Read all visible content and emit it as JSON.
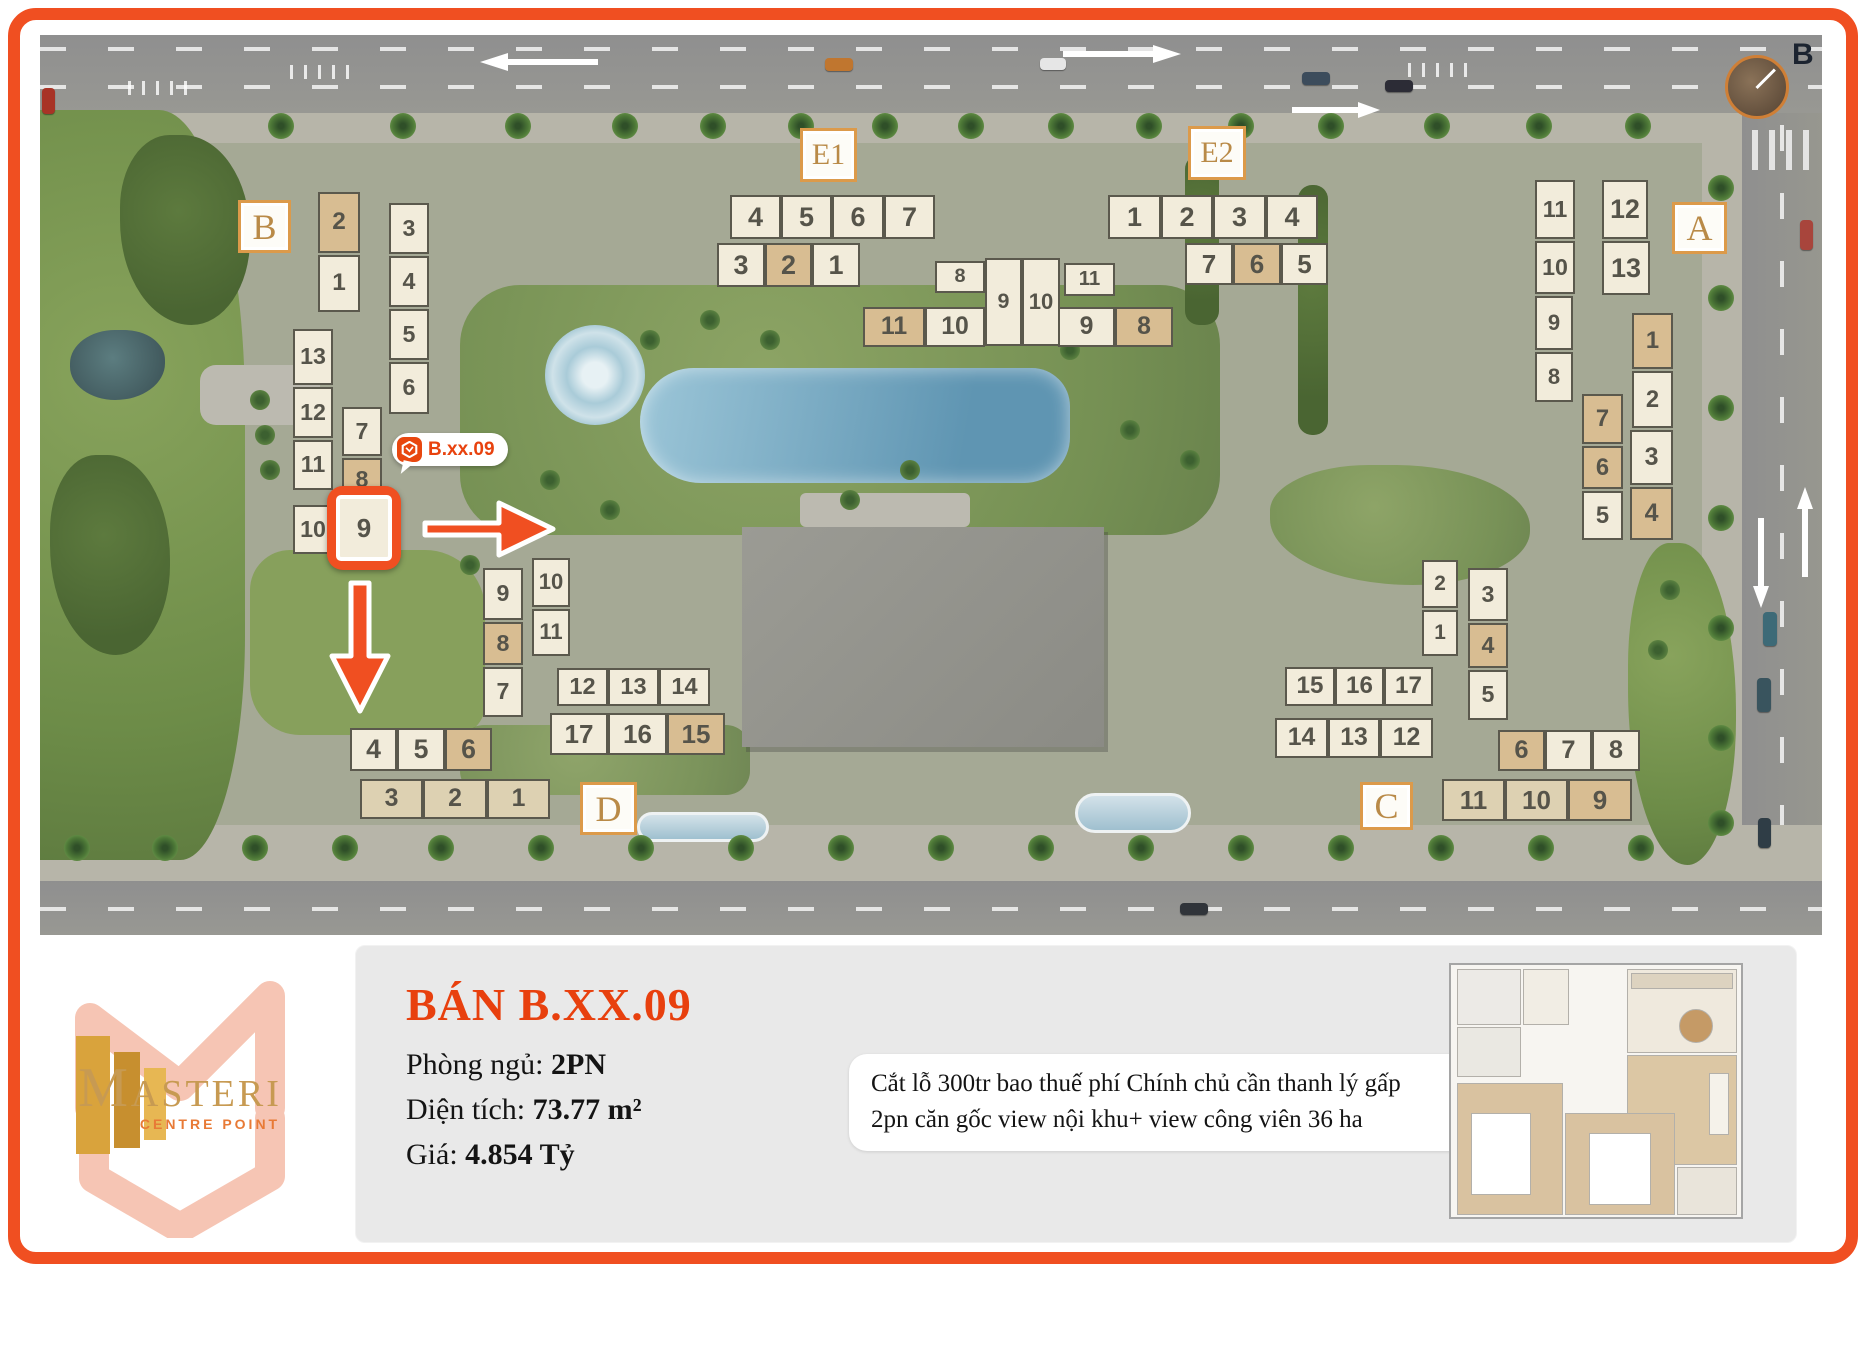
{
  "colors": {
    "accent_orange": "#f04f21",
    "title_red": "#e8400e",
    "label_gold": "#b98a47",
    "unit_cream": "#f2ecdb",
    "unit_tan": "#d8bd92",
    "unit_mid": "#ddd1b2",
    "number_gray": "#56544a"
  },
  "site_plan": {
    "compass": {
      "label": "B"
    },
    "tooltip": {
      "text": "B.xx.09"
    },
    "highlight": {
      "unit": "9",
      "block": "B"
    },
    "block_labels": [
      {
        "text": "B",
        "x": 238,
        "y": 200,
        "w": 53,
        "h": 53
      },
      {
        "text": "E1",
        "x": 800,
        "y": 128,
        "w": 57,
        "h": 54
      },
      {
        "text": "E2",
        "x": 1188,
        "y": 126,
        "w": 58,
        "h": 54
      },
      {
        "text": "A",
        "x": 1672,
        "y": 202,
        "w": 55,
        "h": 52
      },
      {
        "text": "D",
        "x": 580,
        "y": 782,
        "w": 57,
        "h": 53
      },
      {
        "text": "C",
        "x": 1360,
        "y": 782,
        "w": 53,
        "h": 48
      }
    ],
    "units": [
      {
        "blk": "B",
        "n": "2",
        "x": 318,
        "y": 192,
        "w": 42,
        "h": 61,
        "s": "tan"
      },
      {
        "blk": "B",
        "n": "1",
        "x": 318,
        "y": 255,
        "w": 42,
        "h": 57
      },
      {
        "blk": "B",
        "n": "3",
        "x": 389,
        "y": 203,
        "w": 40,
        "h": 51
      },
      {
        "blk": "B",
        "n": "4",
        "x": 389,
        "y": 256,
        "w": 40,
        "h": 51
      },
      {
        "blk": "B",
        "n": "5",
        "x": 389,
        "y": 309,
        "w": 40,
        "h": 51
      },
      {
        "blk": "B",
        "n": "6",
        "x": 389,
        "y": 362,
        "w": 40,
        "h": 52
      },
      {
        "blk": "B",
        "n": "13",
        "x": 293,
        "y": 329,
        "w": 40,
        "h": 56
      },
      {
        "blk": "B",
        "n": "12",
        "x": 293,
        "y": 387,
        "w": 40,
        "h": 51
      },
      {
        "blk": "B",
        "n": "11",
        "x": 293,
        "y": 440,
        "w": 40,
        "h": 50
      },
      {
        "blk": "B",
        "n": "10",
        "x": 293,
        "y": 505,
        "w": 40,
        "h": 49
      },
      {
        "blk": "B",
        "n": "7",
        "x": 342,
        "y": 407,
        "w": 40,
        "h": 49
      },
      {
        "blk": "B",
        "n": "8",
        "x": 342,
        "y": 458,
        "w": 40,
        "h": 44,
        "s": "tan"
      },
      {
        "blk": "E1",
        "n": "4",
        "x": 730,
        "y": 195,
        "w": 51,
        "h": 44
      },
      {
        "blk": "E1",
        "n": "5",
        "x": 781,
        "y": 195,
        "w": 51,
        "h": 44
      },
      {
        "blk": "E1",
        "n": "6",
        "x": 832,
        "y": 195,
        "w": 52,
        "h": 44
      },
      {
        "blk": "E1",
        "n": "7",
        "x": 884,
        "y": 195,
        "w": 51,
        "h": 44
      },
      {
        "blk": "E1",
        "n": "3",
        "x": 717,
        "y": 243,
        "w": 48,
        "h": 44
      },
      {
        "blk": "E1",
        "n": "2",
        "x": 765,
        "y": 243,
        "w": 47,
        "h": 44,
        "s": "tan"
      },
      {
        "blk": "E1",
        "n": "1",
        "x": 812,
        "y": 243,
        "w": 48,
        "h": 44
      },
      {
        "blk": "E",
        "n": "8",
        "x": 935,
        "y": 261,
        "w": 50,
        "h": 32
      },
      {
        "blk": "E",
        "n": "9",
        "x": 985,
        "y": 258,
        "w": 37,
        "h": 88
      },
      {
        "blk": "E",
        "n": "10",
        "x": 1022,
        "y": 258,
        "w": 38,
        "h": 88
      },
      {
        "blk": "E",
        "n": "11",
        "x": 1064,
        "y": 263,
        "w": 51,
        "h": 33
      },
      {
        "blk": "E",
        "n": "11b",
        "label": "11",
        "x": 863,
        "y": 307,
        "w": 62,
        "h": 40,
        "s": "tan"
      },
      {
        "blk": "E",
        "n": "10b",
        "label": "10",
        "x": 925,
        "y": 307,
        "w": 60,
        "h": 40
      },
      {
        "blk": "E",
        "n": "9b",
        "label": "9",
        "x": 1058,
        "y": 307,
        "w": 57,
        "h": 40
      },
      {
        "blk": "E",
        "n": "8b",
        "label": "8",
        "x": 1115,
        "y": 307,
        "w": 58,
        "h": 40,
        "s": "tan"
      },
      {
        "blk": "E2",
        "n": "1",
        "x": 1108,
        "y": 195,
        "w": 53,
        "h": 44
      },
      {
        "blk": "E2",
        "n": "2",
        "x": 1161,
        "y": 195,
        "w": 52,
        "h": 44
      },
      {
        "blk": "E2",
        "n": "3",
        "x": 1213,
        "y": 195,
        "w": 53,
        "h": 44
      },
      {
        "blk": "E2",
        "n": "4",
        "x": 1266,
        "y": 195,
        "w": 52,
        "h": 44
      },
      {
        "blk": "E2",
        "n": "7",
        "x": 1185,
        "y": 243,
        "w": 48,
        "h": 42
      },
      {
        "blk": "E2",
        "n": "6",
        "x": 1233,
        "y": 243,
        "w": 48,
        "h": 42,
        "s": "tan"
      },
      {
        "blk": "E2",
        "n": "5",
        "x": 1281,
        "y": 243,
        "w": 47,
        "h": 42
      },
      {
        "blk": "A",
        "n": "11",
        "x": 1535,
        "y": 180,
        "w": 40,
        "h": 59
      },
      {
        "blk": "A",
        "n": "10",
        "x": 1535,
        "y": 241,
        "w": 40,
        "h": 53
      },
      {
        "blk": "A",
        "n": "9",
        "x": 1535,
        "y": 296,
        "w": 38,
        "h": 54
      },
      {
        "blk": "A",
        "n": "8",
        "x": 1535,
        "y": 352,
        "w": 38,
        "h": 50
      },
      {
        "blk": "A",
        "n": "12",
        "x": 1602,
        "y": 180,
        "w": 46,
        "h": 59
      },
      {
        "blk": "A",
        "n": "13",
        "x": 1602,
        "y": 241,
        "w": 48,
        "h": 54
      },
      {
        "blk": "A",
        "n": "1",
        "x": 1632,
        "y": 313,
        "w": 41,
        "h": 56,
        "s": "tan"
      },
      {
        "blk": "A",
        "n": "2",
        "x": 1632,
        "y": 371,
        "w": 41,
        "h": 57
      },
      {
        "blk": "A",
        "n": "3",
        "x": 1630,
        "y": 430,
        "w": 43,
        "h": 55
      },
      {
        "blk": "A",
        "n": "4",
        "x": 1630,
        "y": 487,
        "w": 43,
        "h": 53,
        "s": "tan"
      },
      {
        "blk": "A",
        "n": "7",
        "x": 1582,
        "y": 394,
        "w": 41,
        "h": 50,
        "s": "tan"
      },
      {
        "blk": "A",
        "n": "6",
        "x": 1582,
        "y": 446,
        "w": 41,
        "h": 43,
        "s": "tan"
      },
      {
        "blk": "A",
        "n": "5",
        "x": 1582,
        "y": 491,
        "w": 41,
        "h": 49
      },
      {
        "blk": "D",
        "n": "9",
        "x": 483,
        "y": 568,
        "w": 40,
        "h": 52
      },
      {
        "blk": "D",
        "n": "8",
        "x": 483,
        "y": 622,
        "w": 40,
        "h": 43,
        "s": "tan"
      },
      {
        "blk": "D",
        "n": "7",
        "x": 483,
        "y": 667,
        "w": 40,
        "h": 50
      },
      {
        "blk": "D",
        "n": "10",
        "x": 532,
        "y": 558,
        "w": 38,
        "h": 49
      },
      {
        "blk": "D",
        "n": "11",
        "x": 532,
        "y": 609,
        "w": 38,
        "h": 47
      },
      {
        "blk": "D",
        "n": "12",
        "x": 557,
        "y": 668,
        "w": 51,
        "h": 38
      },
      {
        "blk": "D",
        "n": "13",
        "x": 608,
        "y": 668,
        "w": 51,
        "h": 38
      },
      {
        "blk": "D",
        "n": "14",
        "x": 659,
        "y": 668,
        "w": 51,
        "h": 38
      },
      {
        "blk": "D",
        "n": "17",
        "x": 550,
        "y": 713,
        "w": 58,
        "h": 42
      },
      {
        "blk": "D",
        "n": "16",
        "x": 608,
        "y": 713,
        "w": 59,
        "h": 42
      },
      {
        "blk": "D",
        "n": "15",
        "x": 667,
        "y": 713,
        "w": 58,
        "h": 42,
        "s": "tan"
      },
      {
        "blk": "D",
        "n": "4",
        "x": 350,
        "y": 728,
        "w": 47,
        "h": 43
      },
      {
        "blk": "D",
        "n": "5",
        "x": 397,
        "y": 728,
        "w": 48,
        "h": 43
      },
      {
        "blk": "D",
        "n": "6",
        "x": 445,
        "y": 728,
        "w": 47,
        "h": 43,
        "s": "tan"
      },
      {
        "blk": "D",
        "n": "3",
        "x": 360,
        "y": 779,
        "w": 63,
        "h": 40,
        "s": "mid"
      },
      {
        "blk": "D",
        "n": "2",
        "x": 423,
        "y": 779,
        "w": 64,
        "h": 40,
        "s": "mid"
      },
      {
        "blk": "D",
        "n": "1",
        "x": 487,
        "y": 779,
        "w": 63,
        "h": 40,
        "s": "mid"
      },
      {
        "blk": "C",
        "n": "2",
        "x": 1422,
        "y": 560,
        "w": 36,
        "h": 48
      },
      {
        "blk": "C",
        "n": "1",
        "x": 1422,
        "y": 610,
        "w": 36,
        "h": 46
      },
      {
        "blk": "C",
        "n": "3",
        "x": 1468,
        "y": 568,
        "w": 40,
        "h": 53
      },
      {
        "blk": "C",
        "n": "4",
        "x": 1468,
        "y": 623,
        "w": 40,
        "h": 45,
        "s": "tan"
      },
      {
        "blk": "C",
        "n": "5",
        "x": 1468,
        "y": 670,
        "w": 40,
        "h": 50
      },
      {
        "blk": "C",
        "n": "15",
        "x": 1285,
        "y": 667,
        "w": 50,
        "h": 39
      },
      {
        "blk": "C",
        "n": "16",
        "x": 1335,
        "y": 667,
        "w": 49,
        "h": 39
      },
      {
        "blk": "C",
        "n": "17",
        "x": 1384,
        "y": 667,
        "w": 49,
        "h": 39
      },
      {
        "blk": "C",
        "n": "14",
        "x": 1275,
        "y": 718,
        "w": 53,
        "h": 40
      },
      {
        "blk": "C",
        "n": "13",
        "x": 1328,
        "y": 718,
        "w": 52,
        "h": 40
      },
      {
        "blk": "C",
        "n": "12",
        "x": 1380,
        "y": 718,
        "w": 53,
        "h": 40
      },
      {
        "blk": "C",
        "n": "6",
        "x": 1498,
        "y": 730,
        "w": 47,
        "h": 41,
        "s": "tan"
      },
      {
        "blk": "C",
        "n": "7",
        "x": 1545,
        "y": 730,
        "w": 47,
        "h": 41
      },
      {
        "blk": "C",
        "n": "8",
        "x": 1592,
        "y": 730,
        "w": 48,
        "h": 41
      },
      {
        "blk": "C",
        "n": "11",
        "x": 1442,
        "y": 779,
        "w": 63,
        "h": 42,
        "s": "mid"
      },
      {
        "blk": "C",
        "n": "10",
        "x": 1505,
        "y": 779,
        "w": 63,
        "h": 42,
        "s": "mid"
      },
      {
        "blk": "C",
        "n": "9",
        "x": 1568,
        "y": 779,
        "w": 64,
        "h": 42,
        "s": "tan"
      }
    ]
  },
  "info_panel": {
    "title": "BÁN B.XX.09",
    "rows": [
      {
        "label": "Phòng ngủ: ",
        "value": "2PN"
      },
      {
        "label": "Diện tích: ",
        "value": "73.77 m²"
      },
      {
        "label": "Giá: ",
        "value": "4.854 Tỷ"
      }
    ],
    "note_line1": "Cắt lỗ 300tr bao thuế phí Chính chủ cần thanh lý gấp",
    "note_line2": "2pn căn gốc view nội khu+ view công viên 36 ha"
  },
  "logo": {
    "brand": "MASTERI",
    "tagline": "CENTRE POINT"
  }
}
